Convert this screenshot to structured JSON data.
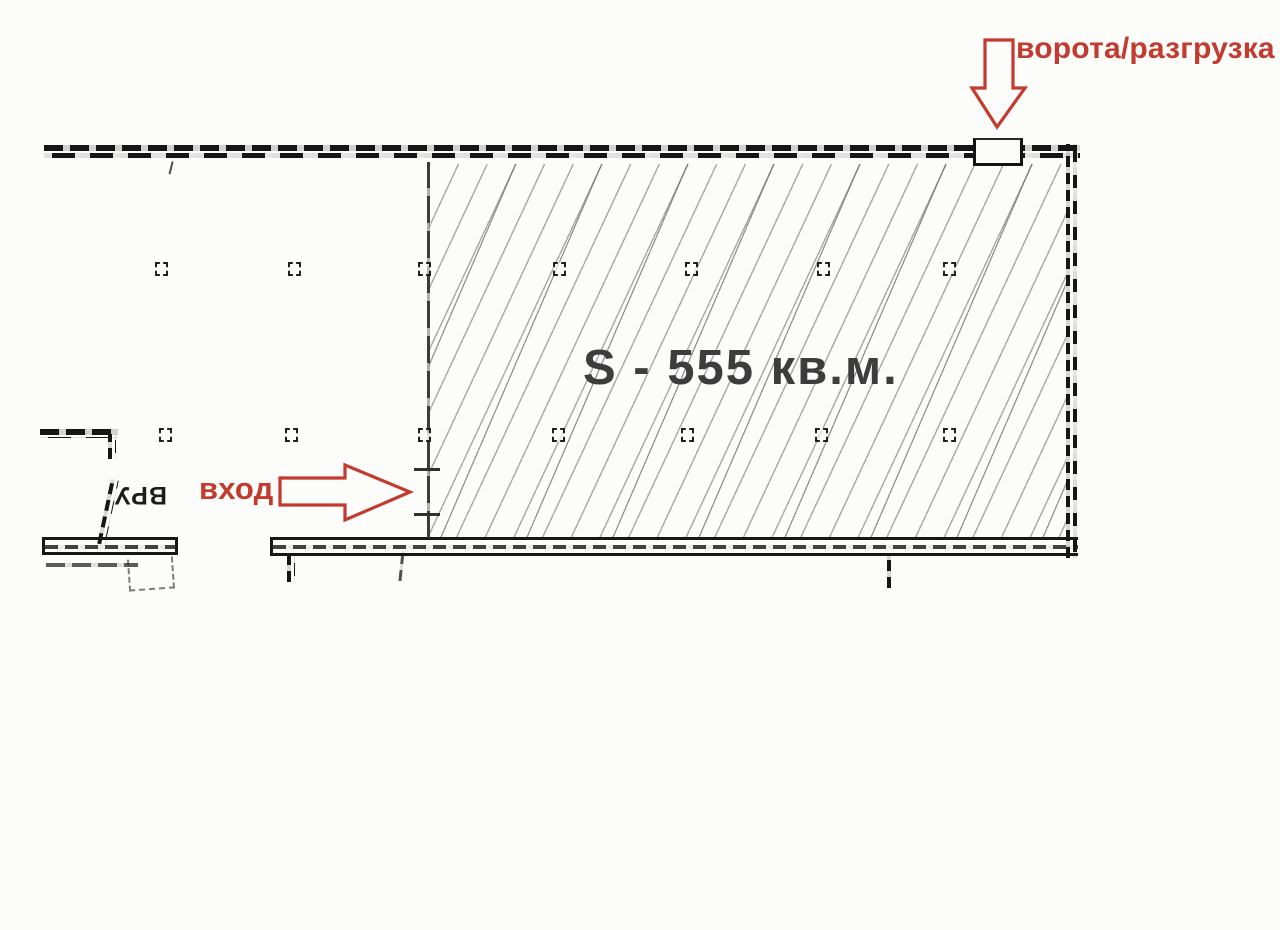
{
  "theme": {
    "red": "#c23b2e",
    "ink": "#1a1a1a",
    "paper": "#fcfcfb",
    "area_text": "#3d3d3d"
  },
  "annotations": {
    "gate_label": "ворота/разгрузка",
    "entrance_label": "вход",
    "area_label": "S - 555 кв.м.",
    "vru_label": "ВРУ"
  },
  "floor_plan": {
    "area_value_sqm": "555",
    "columns": [
      {
        "x": 163,
        "y": 270
      },
      {
        "x": 296,
        "y": 270
      },
      {
        "x": 426,
        "y": 270
      },
      {
        "x": 561,
        "y": 270
      },
      {
        "x": 693,
        "y": 270
      },
      {
        "x": 825,
        "y": 270
      },
      {
        "x": 951,
        "y": 270
      },
      {
        "x": 167,
        "y": 436
      },
      {
        "x": 293,
        "y": 436
      },
      {
        "x": 426,
        "y": 436
      },
      {
        "x": 560,
        "y": 436
      },
      {
        "x": 689,
        "y": 436
      },
      {
        "x": 823,
        "y": 436
      },
      {
        "x": 951,
        "y": 436
      }
    ]
  }
}
